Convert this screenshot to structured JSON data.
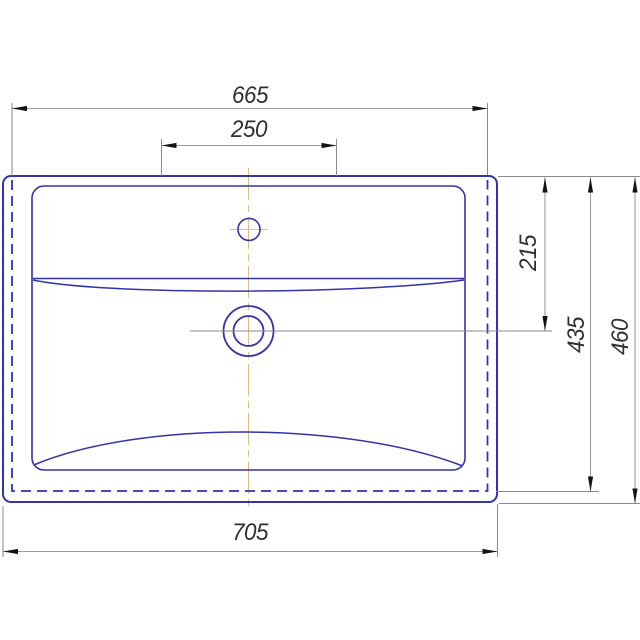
{
  "drawing": {
    "subject": "washbasin-top-view-technical-drawing"
  },
  "dimensions": {
    "hidden_body_width": "665",
    "faucet_zone_width": "250",
    "overall_width": "705",
    "drain_center_offset": "215",
    "hidden_body_depth": "435",
    "overall_depth": "460"
  },
  "colors": {
    "background": "#ffffff",
    "outline": "#3333aa",
    "dimension_line": "#9b9b9b",
    "extension_line": "#8a8a8a",
    "arrow": "#141414",
    "label": "#303030",
    "centerline": "#ddbe86"
  }
}
